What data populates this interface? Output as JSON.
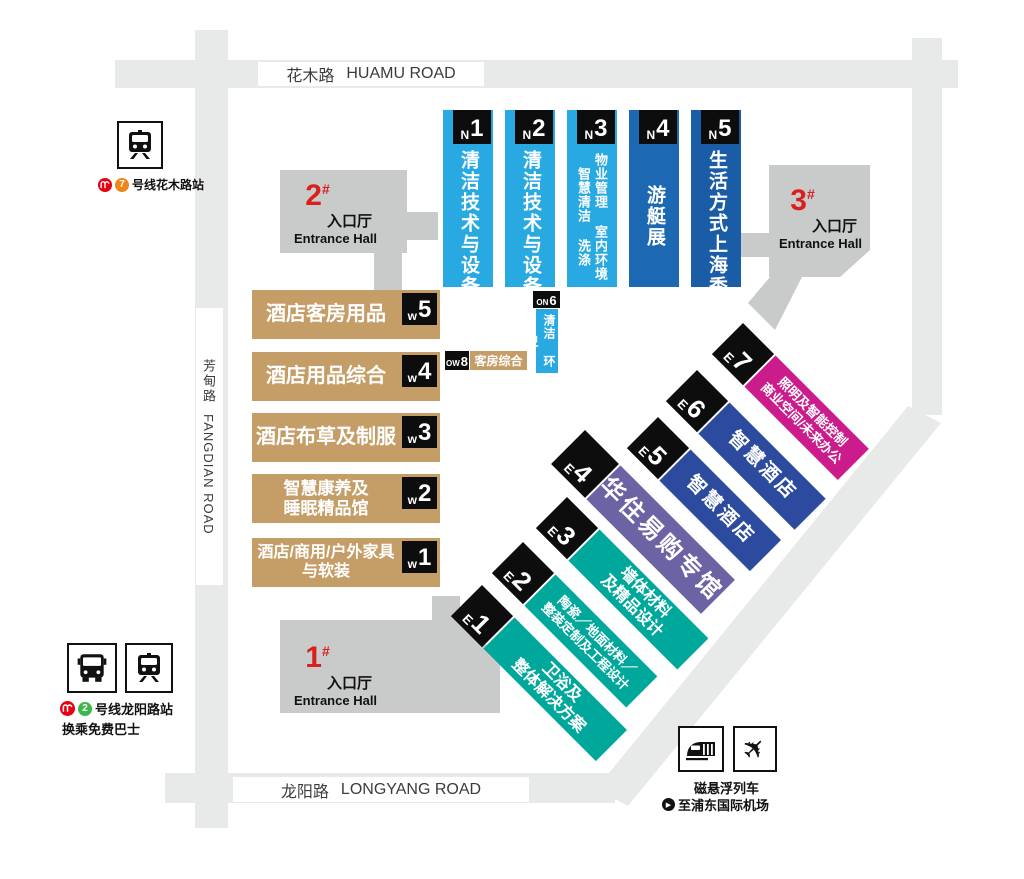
{
  "roads": {
    "huamu": {
      "zh": "花木路",
      "en": "HUAMU ROAD"
    },
    "fangdian": {
      "zh": "芳甸路",
      "en": "FANGDIAN ROAD"
    },
    "longyang": {
      "zh": "龙阳路",
      "en": "LONGYANG ROAD"
    }
  },
  "entrance_halls": [
    {
      "number": "1",
      "suffix": "#",
      "label_zh": "入口厅",
      "label_en": "Entrance Hall"
    },
    {
      "number": "2",
      "suffix": "#",
      "label_zh": "入口厅",
      "label_en": "Entrance Hall"
    },
    {
      "number": "3",
      "suffix": "#",
      "label_zh": "入口厅",
      "label_en": "Entrance Hall"
    }
  ],
  "halls": {
    "north": [
      {
        "badge_prefix": "N",
        "badge_num": "1",
        "name": "清洁技术与设备"
      },
      {
        "badge_prefix": "N",
        "badge_num": "2",
        "name": "清洁技术与设备"
      },
      {
        "badge_prefix": "N",
        "badge_num": "3",
        "col_right": "物业管理 室内环境",
        "col_left": "智慧清洁 洗涤"
      },
      {
        "badge_prefix": "N",
        "badge_num": "4",
        "name": "游艇展"
      },
      {
        "badge_prefix": "N",
        "badge_num": "5",
        "name": "生活方式上海秀"
      }
    ],
    "on6": {
      "badge_prefix": "ON",
      "badge_num": "6",
      "name": "清洁 环卫"
    },
    "west": [
      {
        "badge_prefix": "w",
        "badge_num": "5",
        "name": "酒店客房用品"
      },
      {
        "badge_prefix": "w",
        "badge_num": "4",
        "name": "酒店用品综合"
      },
      {
        "badge_prefix": "w",
        "badge_num": "3",
        "name": "酒店布草及制服"
      },
      {
        "badge_prefix": "w",
        "badge_num": "2",
        "line1": "智慧康养及",
        "line2": "睡眠精品馆"
      },
      {
        "badge_prefix": "w",
        "badge_num": "1",
        "line1": "酒店/商用/户外家具",
        "line2": "与软装"
      }
    ],
    "ow8": {
      "badge_prefix": "OW",
      "badge_num": "8",
      "name": "客房综合"
    },
    "east": [
      {
        "badge_prefix": "E",
        "badge_num": "1",
        "line1": "卫浴及",
        "line2": "整体解决方案"
      },
      {
        "badge_prefix": "E",
        "badge_num": "2",
        "line1": "陶瓷／地面材料／",
        "line2": "整装定制及工程设计"
      },
      {
        "badge_prefix": "E",
        "badge_num": "3",
        "line1": "墙体材料",
        "line2": "及精品设计"
      },
      {
        "badge_prefix": "E",
        "badge_num": "4",
        "name": "华住易购专馆"
      },
      {
        "badge_prefix": "E",
        "badge_num": "5",
        "name": "智慧酒店"
      },
      {
        "badge_prefix": "E",
        "badge_num": "6",
        "name": "智慧酒店"
      },
      {
        "badge_prefix": "E",
        "badge_num": "7",
        "line1": "照明及智能控制",
        "line2": "商业空间/未来办公"
      }
    ]
  },
  "transport": {
    "huamu_station": {
      "line_number": "7",
      "label": "号线花木路站"
    },
    "longyang_station": {
      "line_number": "2",
      "label": "号线龙阳路站",
      "note": "换乘免费巴士"
    },
    "maglev": {
      "title": "磁悬浮列车",
      "destination": "至浦东国际机场"
    }
  },
  "colors": {
    "hall_light_blue": "#29A9E1",
    "hall_blue_n4": "#1C68B2",
    "hall_blue_n5": "#1B5CA6",
    "hall_tan": "#C59D67",
    "hall_teal": "#00A79B",
    "hall_purple": "#6C63A5",
    "hall_indigo": "#2C4B9E",
    "hall_magenta": "#CB1C8C",
    "entrance_gray": "#C9CACA",
    "road_gray": "#E8E9E9",
    "accent_red": "#D8211F",
    "badge_black": "#0D0D0D",
    "metro_logo_red": "#E60012",
    "line7_orange": "#F08519",
    "line2_green": "#3DB64B"
  }
}
